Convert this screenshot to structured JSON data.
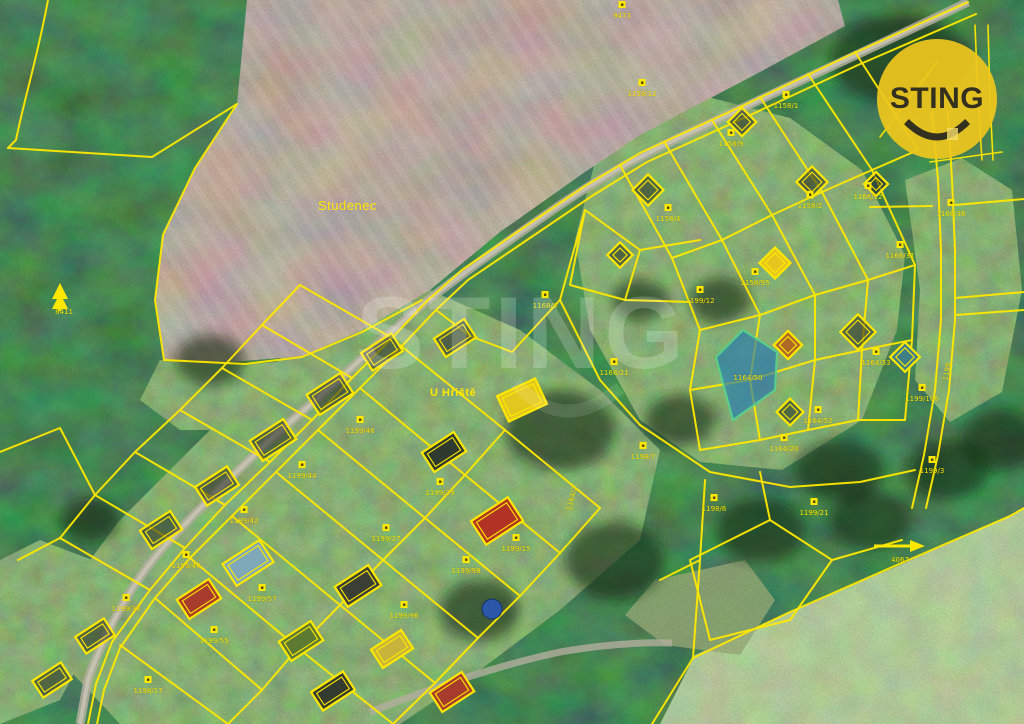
{
  "map": {
    "place_label": "Studenec",
    "street_label": "U Hřiště",
    "watermark_text": "STING",
    "logo": {
      "text": "STING",
      "bg_color": "#eec61d",
      "fg_color": "#33301f"
    },
    "highlight_parcel": {
      "number": "1164/50",
      "fill": "#1d76b4",
      "stroke": "#57d08d"
    },
    "colors": {
      "parcel_line": "#ffe800",
      "road": "#b3ae9e",
      "forest": "#263d24",
      "field": "#6e5a52",
      "meadow": "#7f9e5f"
    },
    "symbols": [
      {
        "name": "coniferous-tree-symbol",
        "label": "8411"
      },
      {
        "name": "direction-arrow-symbol",
        "label": "4067"
      }
    ],
    "parcel_labels": [
      {
        "t": "9473",
        "x": 622,
        "y": 18,
        "m": true
      },
      {
        "t": "8411",
        "x": 64,
        "y": 314
      },
      {
        "t": "1158/12",
        "x": 642,
        "y": 96,
        "m": true
      },
      {
        "t": "1158/1",
        "x": 786,
        "y": 108,
        "m": true
      },
      {
        "t": "1158/9",
        "x": 731,
        "y": 146,
        "m": true
      },
      {
        "t": "1158/4",
        "x": 668,
        "y": 221,
        "m": true
      },
      {
        "t": "1158/2",
        "x": 810,
        "y": 208,
        "m": true
      },
      {
        "t": "1166/12",
        "x": 868,
        "y": 199,
        "m": true
      },
      {
        "t": "1166/36",
        "x": 951,
        "y": 216,
        "m": true
      },
      {
        "t": "1166/31",
        "x": 900,
        "y": 258,
        "m": true
      },
      {
        "t": "1158/95",
        "x": 755,
        "y": 285,
        "m": true
      },
      {
        "t": "1168/21",
        "x": 614,
        "y": 375,
        "m": true
      },
      {
        "t": "1168/9",
        "x": 545,
        "y": 308,
        "m": true
      },
      {
        "t": "1199/12",
        "x": 700,
        "y": 303,
        "m": true
      },
      {
        "t": "1164/52",
        "x": 818,
        "y": 423,
        "m": true
      },
      {
        "t": "1164/33",
        "x": 876,
        "y": 365,
        "m": true
      },
      {
        "t": "1164/20",
        "x": 784,
        "y": 451,
        "m": true
      },
      {
        "t": "1199/106",
        "x": 922,
        "y": 401,
        "m": true
      },
      {
        "t": "1199",
        "x": 949,
        "y": 372,
        "r": -80
      },
      {
        "t": "1164/2",
        "x": 574,
        "y": 499,
        "r": -75
      },
      {
        "t": "1199/3",
        "x": 932,
        "y": 473,
        "m": true
      },
      {
        "t": "4067",
        "x": 900,
        "y": 562
      },
      {
        "t": "1198/7",
        "x": 643,
        "y": 459,
        "m": true
      },
      {
        "t": "1198/6",
        "x": 714,
        "y": 511,
        "m": true
      },
      {
        "t": "1199/21",
        "x": 814,
        "y": 515,
        "m": true
      },
      {
        "t": "1199/46",
        "x": 360,
        "y": 433,
        "m": true
      },
      {
        "t": "1199/44",
        "x": 302,
        "y": 478,
        "m": true
      },
      {
        "t": "1199/42",
        "x": 244,
        "y": 523,
        "m": true
      },
      {
        "t": "1199/40",
        "x": 186,
        "y": 568,
        "m": true
      },
      {
        "t": "1199/38",
        "x": 126,
        "y": 611,
        "m": true
      },
      {
        "t": "1199/29",
        "x": 440,
        "y": 495,
        "m": true
      },
      {
        "t": "1199/27",
        "x": 386,
        "y": 541,
        "m": true
      },
      {
        "t": "1199/57",
        "x": 262,
        "y": 601,
        "m": true
      },
      {
        "t": "1199/55",
        "x": 214,
        "y": 643,
        "m": true
      },
      {
        "t": "1199/96",
        "x": 404,
        "y": 618,
        "m": true
      },
      {
        "t": "1199/98",
        "x": 466,
        "y": 573,
        "m": true
      },
      {
        "t": "1199/15",
        "x": 516,
        "y": 551,
        "m": true
      },
      {
        "t": "1198/17",
        "x": 148,
        "y": 693,
        "m": true
      }
    ]
  }
}
